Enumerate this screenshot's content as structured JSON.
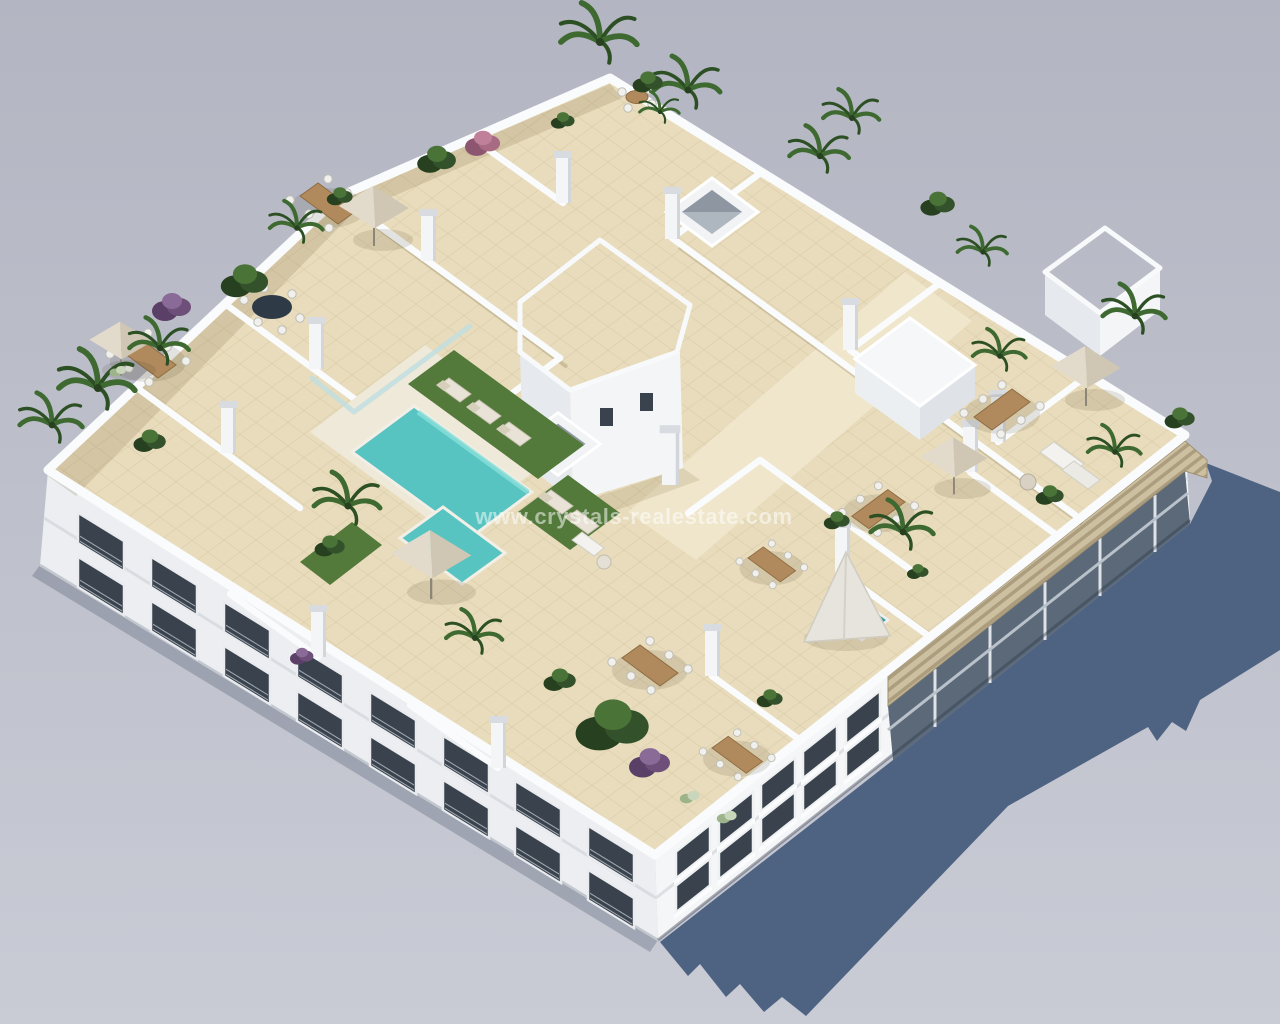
{
  "meta": {
    "type": "3d-architectural-aerial-render",
    "canvas": {
      "width": 1280,
      "height": 1024
    }
  },
  "watermark": {
    "text": "www.crystals-realestate.com"
  },
  "palette": {
    "background_top": "#b3b5c2",
    "background_bottom": "#c9cbd5",
    "shadow": "#4e6382",
    "contact_shadow": "rgba(90,100,120,0.35)",
    "facade_light": "#f5f6f8",
    "facade_side": "#eceef1",
    "facade_recess": "#5b6979",
    "window_dark": "#39424d",
    "roof_tile": "#e8dcbc",
    "walkway": "#efe6cb",
    "pool_deck": "#eee9d8",
    "parapet_white": "#fafbfc",
    "gravel": "#b2a69a",
    "pool": "#57c4c2",
    "pool_rim": "#8adfd8",
    "plunge_pool": "#3f9ea0",
    "lawn": "#53793b",
    "pergola_slats": "#cdc0a0",
    "umbrella": "#d9d1c1",
    "teepee": "#e7e4dd",
    "wood": "#b08a5c",
    "plant_dark": "#27401f",
    "plant_light": "#4a7337",
    "purple_plant": "#6d4f79",
    "pink_plant": "#a86b83"
  },
  "scene": {
    "setting": "aerial three-quarter render of a white apartment block on a plain grey ground",
    "sun_direction": "upper-left",
    "cast_shadow_direction": "lower-right",
    "building": {
      "stories_visible": 3,
      "left_facade": "white facade with recessed glazed balconies",
      "front_facade": "white facade with dark window openings",
      "right_facade": "recessed balconies under a timber louvre pergola, in shade",
      "roof": "communal rooftop of beige-tiled private terraces divided by white parapet walls"
    },
    "inventory": {
      "parasols": 5,
      "teepee_shades": 1,
      "dining_sets": 7,
      "lounge_corners": 2,
      "sun_loungers": 5,
      "skylights": 3,
      "stair_cores_with_gravel_roof": 2,
      "roof_access_box": 1,
      "swimming_pool": "L-shaped turquoise pool with artificial-grass sun deck",
      "plunge_pool": 1,
      "planting": [
        "palms",
        "green shrubs",
        "purple flowering shrubs",
        "pink flowering shrub",
        "pale shrubs"
      ]
    }
  }
}
